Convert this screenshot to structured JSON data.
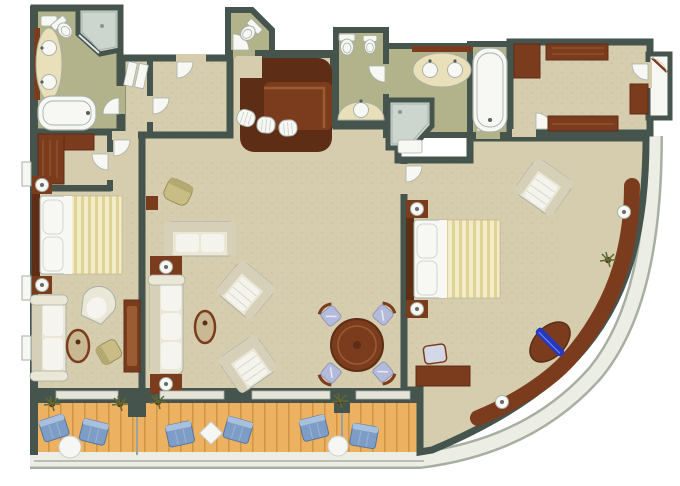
{
  "document": {
    "type": "architectural-floor-plan",
    "title": "Luxury suite floor plan",
    "render_style": "3D top-down rendering, no text labels",
    "shape": "rectangular plan with curved hull wall at lower right"
  },
  "colors": {
    "bg": "#ffffff",
    "wall": "#46544e",
    "wall_dark": "#39453f",
    "outer_line": "#a9aea2",
    "rail": "#eceee6",
    "carpet": "#d6cdae",
    "carpet_speck": "#90855f",
    "bath_floor": "#b2b28b",
    "shower_floor": "#ccd6cf",
    "glass": "#dfe7ea",
    "fixture_white": "#f7f8f4",
    "fixture_line": "#a8b1a8",
    "counter_cream": "#e9dfb9",
    "wood_dark": "#5e2d15",
    "wood": "#7b3c1e",
    "wood_light": "#9a5c33",
    "deck": "#ecb261",
    "deck_line": "#cd9340",
    "bed_base": "#f3ecc9",
    "bed_stripe": "#e0d196",
    "textile_cream": "#ebe7d6",
    "textile_stripe": "#d6d0b9",
    "cushion_blue": "#b4badb",
    "lounge_blue": "#7e9dc6",
    "lounge_blue_light": "#a9c0dd",
    "accent_blue": "#2339c4",
    "plant_green": "#5c6b33",
    "table_top": "#c9b992",
    "table_white": "#f6f6f2",
    "olive_chair": "#c9bd85"
  },
  "rooms": [
    {
      "id": "guest-bathroom",
      "fixtures": [
        "double-sink vanity",
        "toilet",
        "corner shower",
        "bathtub"
      ]
    },
    {
      "id": "guest-closet",
      "fixtures": [
        "L-shaped wardrobe"
      ]
    },
    {
      "id": "entry-hall",
      "fixtures": [
        "closet doors",
        "interior doors"
      ]
    },
    {
      "id": "powder-room",
      "fixtures": [
        "toilet"
      ]
    },
    {
      "id": "wet-bar",
      "fixtures": [
        "mahogany bar counter",
        "3 bar stools"
      ]
    },
    {
      "id": "master-water-closet",
      "fixtures": [
        "toilet",
        "bidet",
        "vanity sink"
      ]
    },
    {
      "id": "master-bathroom",
      "fixtures": [
        "double-sink vanity",
        "corner shower",
        "soaking bathtub"
      ]
    },
    {
      "id": "dressing-room",
      "fixtures": [
        "4 wardrobe cabinets"
      ]
    },
    {
      "id": "entry-vestibule",
      "fixtures": [
        "suite entry door"
      ]
    },
    {
      "id": "guest-bedroom",
      "furniture": [
        "queen bed with striped duvet",
        "2 nightstands with lamps",
        "striped sofa",
        "barrel chair",
        "oval coffee table",
        "desk chair",
        "dressing table"
      ]
    },
    {
      "id": "living-room",
      "furniture": [
        "loveseat",
        "long sofa",
        "2 striped armchairs",
        "oval coffee table",
        "round dining table",
        "4 dining chairs with blue cushions",
        "2 lamp side tables",
        "olive wing chair"
      ]
    },
    {
      "id": "master-bedroom",
      "furniture": [
        "queen bed with striped duvet",
        "2 nightstands with lamps",
        "striped armchair",
        "desk with chair",
        "curved window console",
        "blue bench inlay",
        "2 console lamps",
        "plant"
      ]
    },
    {
      "id": "balcony",
      "furniture": [
        "6 blue lounge chairs",
        "2 round white cocktail tables",
        "white square cocktail table",
        "3 planters",
        "2 privacy partitions",
        "teak plank deck"
      ]
    }
  ]
}
